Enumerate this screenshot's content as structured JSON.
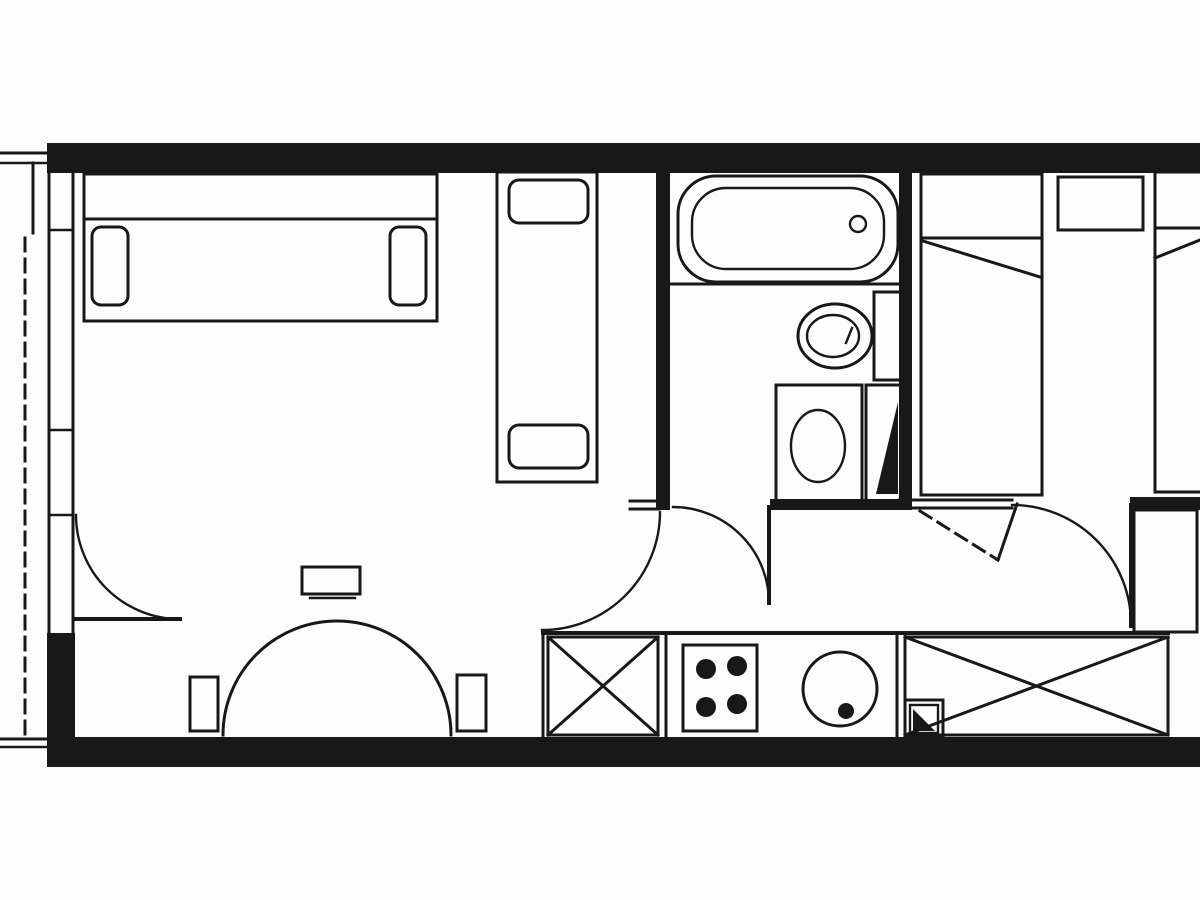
{
  "meta": {
    "document_type": "architectural-floor-plan",
    "style": "black-and-white scanned line drawing",
    "visible_text": "none"
  },
  "palette": {
    "background": "#fdfdfd",
    "ink": "#181818"
  },
  "plan": {
    "rooms": [
      {
        "name": "living-room",
        "furniture": [
          "sofa-with-armrests",
          "single-bed-with-two-pillows",
          "semicircular-dining-table",
          "chair",
          "chair",
          "chair"
        ],
        "doors": [
          "balcony-door-swing",
          "opening-to-hall-swing"
        ]
      },
      {
        "name": "bathroom",
        "fixtures": [
          "bathtub-with-drain",
          "toilet-with-cistern",
          "washbasin",
          "service-shaft-triangle"
        ],
        "doors": [
          "bathroom-door-swing"
        ]
      },
      {
        "name": "kitchen",
        "fixtures": [
          "base-cabinet-x",
          "cooktop-4-burners",
          "round-sink-with-drain",
          "base-cabinet-x",
          "service-shaft-triangle"
        ]
      },
      {
        "name": "bedroom",
        "furniture": [
          "single-bed",
          "single-bed",
          "nightstand",
          "cabinet",
          "wardrobe-x"
        ],
        "doors": [
          "bedroom-door-swing",
          "dashed-folding-door-symbol"
        ]
      },
      {
        "name": "balcony",
        "representation": "dashed-outline-left-edge"
      }
    ]
  }
}
